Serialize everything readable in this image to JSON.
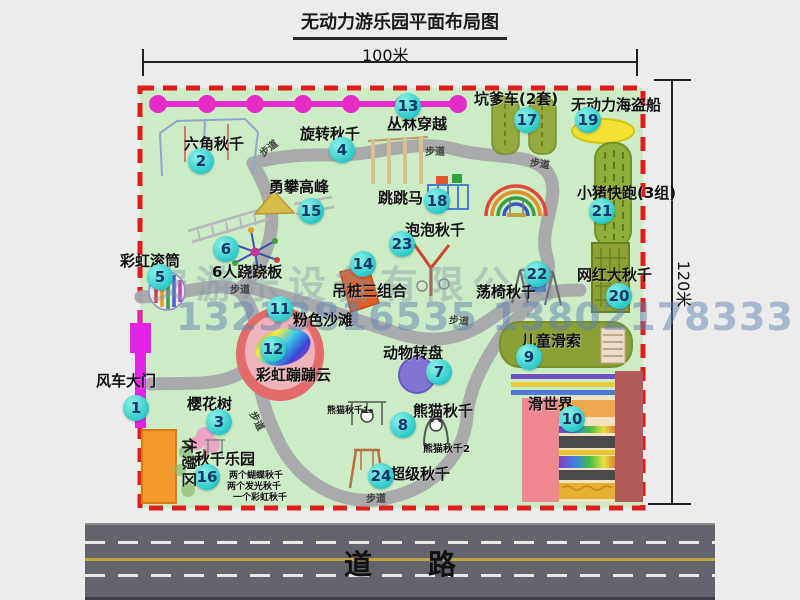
{
  "title": "无动力游乐园平面布局图",
  "dimensions": {
    "width_label": "100米",
    "height_label": "120米"
  },
  "watermark": {
    "company": "安游乐设备有限公司",
    "phone": "13233816535 13802178333"
  },
  "road_label": "道　　路",
  "rest_area_label": "休憩区",
  "path_label": "步道",
  "attractions": [
    {
      "num": "1",
      "label": "风车大门"
    },
    {
      "num": "2",
      "label": "六角秋千"
    },
    {
      "num": "3",
      "label": "樱花树"
    },
    {
      "num": "4",
      "label": "旋转秋千"
    },
    {
      "num": "5",
      "label": "彩虹滚筒"
    },
    {
      "num": "6",
      "label": "6人跷跷板"
    },
    {
      "num": "7",
      "label": "动物转盘"
    },
    {
      "num": "8",
      "label": "熊猫秋千"
    },
    {
      "num": "9",
      "label": "儿童滑索"
    },
    {
      "num": "10",
      "label": "滑世界"
    },
    {
      "num": "11",
      "label": "粉色沙滩"
    },
    {
      "num": "12",
      "label": "彩虹蹦蹦云"
    },
    {
      "num": "13",
      "label": "丛林穿越"
    },
    {
      "num": "14",
      "label": "吊桩三组合"
    },
    {
      "num": "15",
      "label": "勇攀高峰"
    },
    {
      "num": "16",
      "label": "秋千乐园"
    },
    {
      "num": "17",
      "label": "坑爹车(2套)"
    },
    {
      "num": "18",
      "label": "跳跳马"
    },
    {
      "num": "19",
      "label": "无动力海盗船"
    },
    {
      "num": "20",
      "label": "网红大秋千"
    },
    {
      "num": "21",
      "label": "小猪快跑(3组)"
    },
    {
      "num": "22",
      "label": "荡椅秋千"
    },
    {
      "num": "23",
      "label": "泡泡秋千"
    },
    {
      "num": "24",
      "label": "超级秋千"
    }
  ],
  "sub_labels": {
    "panda1": "熊猫秋千1",
    "panda2": "熊猫秋千2",
    "swing_detail_1": "两个蝴蝶秋千",
    "swing_detail_2": "两个发光秋千",
    "swing_detail_3": "一个彩虹秋千"
  },
  "colors": {
    "park_green": "#cbecc5",
    "border_red": "#e21b1b",
    "badge_teal": "#2cc9c9",
    "gate_magenta": "#e322e3",
    "road_gray": "#64646c"
  }
}
